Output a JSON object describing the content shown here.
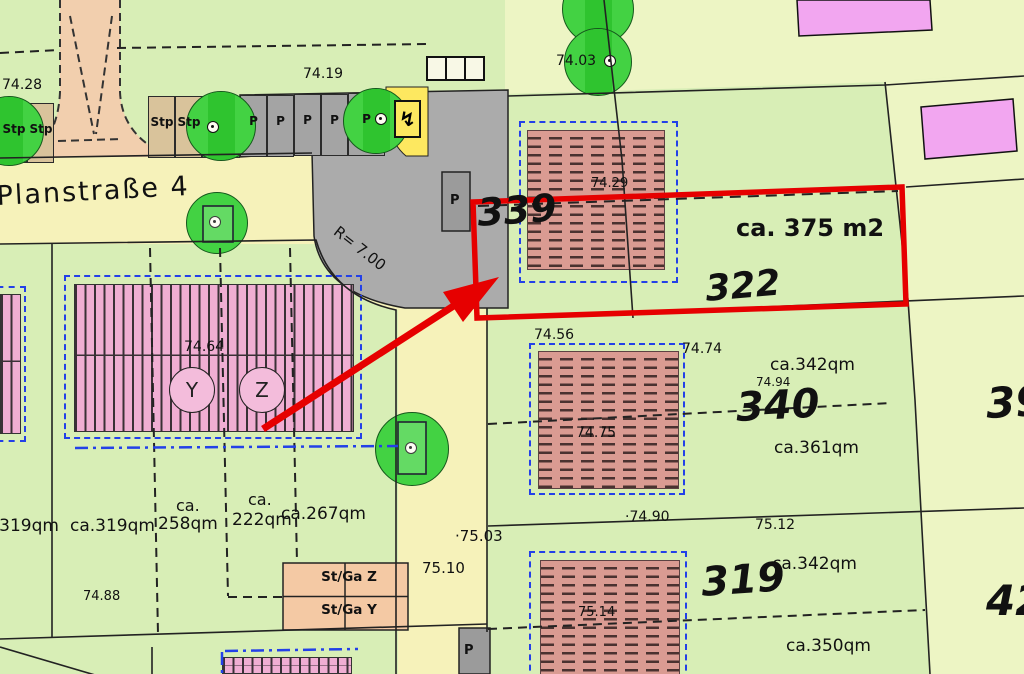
{
  "palette": {
    "highlight_red": "#e60000",
    "boundary_blue": "#2340e8",
    "road_yellow": "#f6f2ba",
    "grass_green": "#d8eeb6",
    "grass_light": "#edf5c4",
    "tree_green": "#43d243",
    "tree_band_green": "#2fc42f",
    "building_hatch": "#da9b92",
    "building_stripe_pink": "#f0aed3",
    "building_magenta": "#f2a6f0",
    "garage_tan": "#f4c9a4",
    "stall_tan": "#d9c39b",
    "parking_gray": "#ababab",
    "path_peach": "#f2cfae",
    "transformer_yellow": "#fde860"
  },
  "icons": {
    "transformer": "↯"
  },
  "labels": [
    {
      "id": "elev-74-28",
      "t": "74.28",
      "x": 2,
      "y": 78,
      "fs": 14
    },
    {
      "id": "elev-74-19",
      "t": "74.19",
      "x": 303,
      "y": 67,
      "fs": 14
    },
    {
      "id": "street-name",
      "t": "Planstraße 4",
      "x": -4,
      "y": 183,
      "fs": 27,
      "rot": -3,
      "ls": 2
    },
    {
      "id": "elev-74-03",
      "t": "74.03",
      "x": 556,
      "y": 54,
      "fs": 14
    },
    {
      "id": "plot-339",
      "t": "339",
      "x": 476,
      "y": 194,
      "fs": 38,
      "b": 1,
      "i": 1,
      "rot": -4
    },
    {
      "id": "area-375",
      "t": "ca. 375 m2",
      "x": 736,
      "y": 216,
      "fs": 24,
      "b": 1
    },
    {
      "id": "plot-322",
      "t": "322",
      "x": 704,
      "y": 272,
      "fs": 36,
      "b": 1,
      "i": 1,
      "rot": -5
    },
    {
      "id": "elev-74-29",
      "t": "74.29",
      "x": 591,
      "y": 177,
      "fs": 13
    },
    {
      "id": "elev-74-56",
      "t": "74.56",
      "x": 534,
      "y": 328,
      "fs": 14
    },
    {
      "id": "elev-74-74",
      "t": "74.74",
      "x": 682,
      "y": 342,
      "fs": 14
    },
    {
      "id": "plot-340",
      "t": "340",
      "x": 735,
      "y": 388,
      "fs": 40,
      "b": 1,
      "i": 1,
      "rot": -3
    },
    {
      "id": "area-342-top",
      "t": "ca.342qm",
      "x": 770,
      "y": 357,
      "fs": 17
    },
    {
      "id": "elev-74-94",
      "t": "74.94",
      "x": 756,
      "y": 376,
      "fs": 12
    },
    {
      "id": "area-361",
      "t": "ca.361qm",
      "x": 774,
      "y": 440,
      "fs": 17
    },
    {
      "id": "elev-74-75",
      "t": "74.75",
      "x": 576,
      "y": 426,
      "fs": 14
    },
    {
      "id": "plot-39",
      "t": "39",
      "x": 985,
      "y": 383,
      "fs": 42,
      "b": 1,
      "i": 1,
      "rot": -3
    },
    {
      "id": "elev-74-64",
      "t": "74.64",
      "x": 184,
      "y": 340,
      "fs": 14
    },
    {
      "id": "area-319-left",
      "t": "ca.319qm",
      "x": -26,
      "y": 518,
      "fs": 17
    },
    {
      "id": "area-319",
      "t": "ca.319qm",
      "x": 70,
      "y": 518,
      "fs": 17
    },
    {
      "id": "area-258-ca",
      "t": "ca.",
      "x": 176,
      "y": 498,
      "fs": 16
    },
    {
      "id": "area-258",
      "t": "258qm",
      "x": 158,
      "y": 516,
      "fs": 17
    },
    {
      "id": "area-222-ca",
      "t": "ca.",
      "x": 248,
      "y": 492,
      "fs": 16
    },
    {
      "id": "area-222",
      "t": "222qm",
      "x": 232,
      "y": 512,
      "fs": 17
    },
    {
      "id": "area-267",
      "t": "ca.267qm",
      "x": 281,
      "y": 506,
      "fs": 17
    },
    {
      "id": "elev-74-88",
      "t": "74.88",
      "x": 83,
      "y": 590,
      "fs": 13
    },
    {
      "id": "elev-75-10",
      "t": "75.10",
      "x": 422,
      "y": 561,
      "fs": 15
    },
    {
      "id": "elev-75-03",
      "t": "·75.03",
      "x": 455,
      "y": 529,
      "fs": 15
    },
    {
      "id": "elev-74-90",
      "t": "·74.90",
      "x": 625,
      "y": 510,
      "fs": 14
    },
    {
      "id": "elev-75-12",
      "t": "75.12",
      "x": 755,
      "y": 518,
      "fs": 14
    },
    {
      "id": "plot-319",
      "t": "319",
      "x": 700,
      "y": 563,
      "fs": 40,
      "b": 1,
      "i": 1,
      "rot": -4
    },
    {
      "id": "area-342-bottom",
      "t": "ca.342qm",
      "x": 772,
      "y": 556,
      "fs": 17
    },
    {
      "id": "elev-75-14",
      "t": "75.14",
      "x": 578,
      "y": 606,
      "fs": 13
    },
    {
      "id": "area-350",
      "t": "ca.350qm",
      "x": 786,
      "y": 638,
      "fs": 17
    },
    {
      "id": "plot-42",
      "t": "42",
      "x": 986,
      "y": 580,
      "fs": 42,
      "b": 1,
      "i": 1
    },
    {
      "id": "radius-label",
      "t": "R= 7.00",
      "x": 340,
      "y": 224,
      "fs": 15,
      "rot": 38
    },
    {
      "id": "parking-pad-label",
      "t": "P",
      "x": 450,
      "y": 194,
      "fs": 13,
      "b": 1
    },
    {
      "id": "parking-bottom-label",
      "t": "P",
      "x": 464,
      "y": 644,
      "fs": 13,
      "b": 1
    }
  ],
  "stalls": [
    {
      "x": 0,
      "y": 103,
      "w": 27,
      "h": 60,
      "f": "tan",
      "label": "Stp"
    },
    {
      "x": 27,
      "y": 103,
      "w": 27,
      "h": 60,
      "f": "tan",
      "label": "Stp"
    },
    {
      "x": 148,
      "y": 96,
      "w": 27,
      "h": 62,
      "f": "tan",
      "label": "Stp"
    },
    {
      "x": 175,
      "y": 96,
      "w": 27,
      "h": 62,
      "f": "tan",
      "label": "Stp"
    },
    {
      "x": 202,
      "y": 96,
      "w": 38,
      "h": 62,
      "f": "green",
      "label": ""
    },
    {
      "x": 240,
      "y": 95,
      "w": 27,
      "h": 62,
      "f": "gray",
      "label": "P"
    },
    {
      "x": 267,
      "y": 95,
      "w": 27,
      "h": 62,
      "f": "gray",
      "label": "P"
    },
    {
      "x": 294,
      "y": 94,
      "w": 27,
      "h": 62,
      "f": "gray",
      "label": "P"
    },
    {
      "x": 321,
      "y": 94,
      "w": 27,
      "h": 62,
      "f": "gray",
      "label": "P"
    },
    {
      "x": 348,
      "y": 93,
      "w": 37,
      "h": 63,
      "f": "gray",
      "label": "P"
    }
  ],
  "trees": [
    {
      "cx": 9,
      "cy": 131,
      "r": 35,
      "band": 1
    },
    {
      "cx": 221,
      "cy": 126,
      "r": 35,
      "band": 1,
      "fx": 213,
      "fy": 127
    },
    {
      "cx": 376,
      "cy": 121,
      "r": 33,
      "band": 1,
      "fx": 381,
      "fy": 119
    },
    {
      "cx": 217,
      "cy": 223,
      "r": 31,
      "fx": 215,
      "fy": 222
    },
    {
      "cx": 412,
      "cy": 449,
      "r": 37,
      "fx": 411,
      "fy": 448
    },
    {
      "cx": 598,
      "cy": 9,
      "r": 36,
      "band": 1
    },
    {
      "cx": 598,
      "cy": 62,
      "r": 34,
      "band": 1,
      "fx": 610,
      "fy": 61
    }
  ],
  "unit_circles": [
    {
      "label": "Y",
      "cx": 192,
      "cy": 390
    },
    {
      "label": "Z",
      "cx": 262,
      "cy": 390
    }
  ],
  "garage": {
    "rows": [
      {
        "label": "St/Ga  Z"
      },
      {
        "label": "St/Ga  Y"
      }
    ]
  }
}
